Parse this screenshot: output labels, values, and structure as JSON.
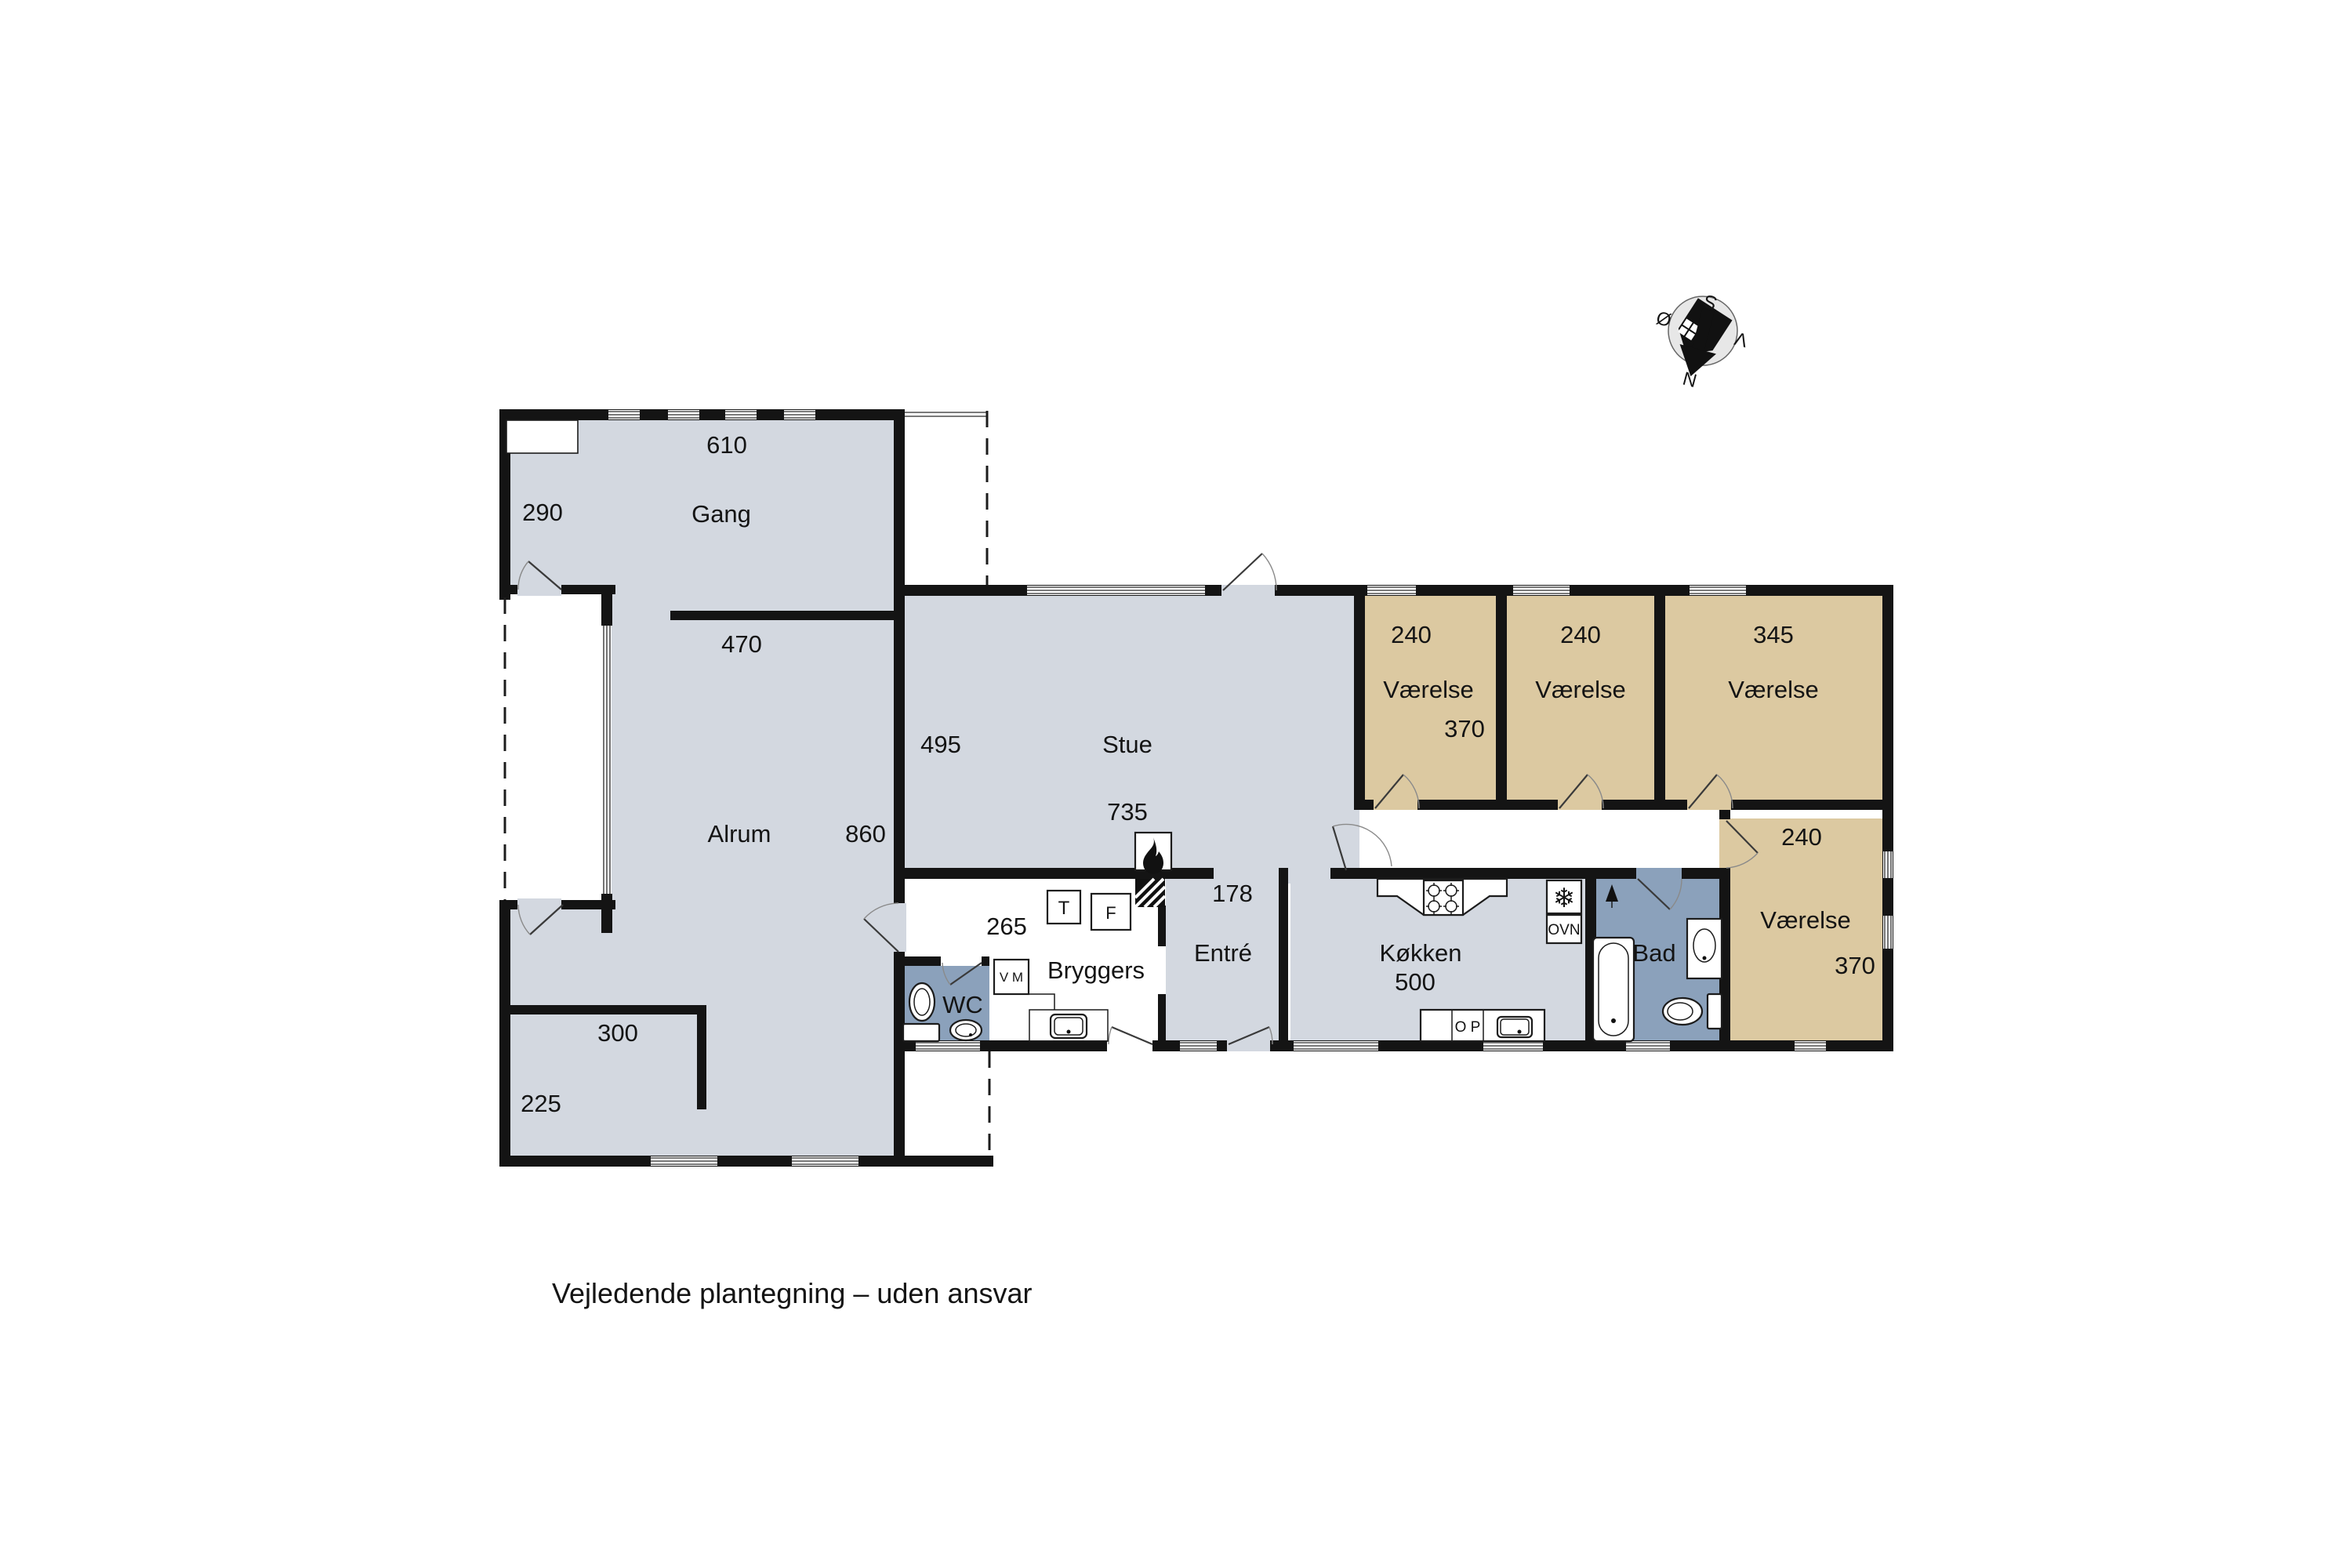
{
  "plan_title": {
    "disclaimer": "Vejledende plantegning – uden ansvar"
  },
  "compass": {
    "north": "N",
    "south": "S",
    "east": "Ø",
    "west": "V"
  },
  "colors": {
    "floor": "#d3d8e0",
    "bedroom": "#dcc9a1",
    "bath": "#8ba1bb",
    "wall": "#141414",
    "compass_fill": "#e7e7e7"
  },
  "rooms": {
    "gang": {
      "label": "Gang",
      "dim_width": "610",
      "dim_side": "290",
      "dim_bottom": "470"
    },
    "alrum": {
      "label": "Alrum",
      "dim_height": "860",
      "dim_nook_width": "300",
      "dim_nook_side": "225"
    },
    "stue": {
      "label": "Stue",
      "dim_side": "495",
      "dim_width": "735"
    },
    "bryggers": {
      "label": "Bryggers",
      "dim_width": "265"
    },
    "entre": {
      "label": "Entré",
      "dim_width": "178"
    },
    "wc": {
      "label": "WC"
    },
    "kokken": {
      "label": "Køkken",
      "dim_width": "500"
    },
    "bad": {
      "label": "Bad"
    },
    "vaerelse_1": {
      "label": "Værelse",
      "dim_width": "240",
      "dim_height": "370"
    },
    "vaerelse_2": {
      "label": "Værelse",
      "dim_width": "240"
    },
    "vaerelse_3": {
      "label": "Værelse",
      "dim_width": "345"
    },
    "vaerelse_4": {
      "label": "Værelse",
      "dim_width": "240",
      "dim_height": "370"
    }
  },
  "appliances": {
    "washing_machine": "V M",
    "dryer": "T",
    "freezer": "F",
    "freezer_icon": "❄",
    "oven": "OVN",
    "dishwasher": "O P"
  }
}
